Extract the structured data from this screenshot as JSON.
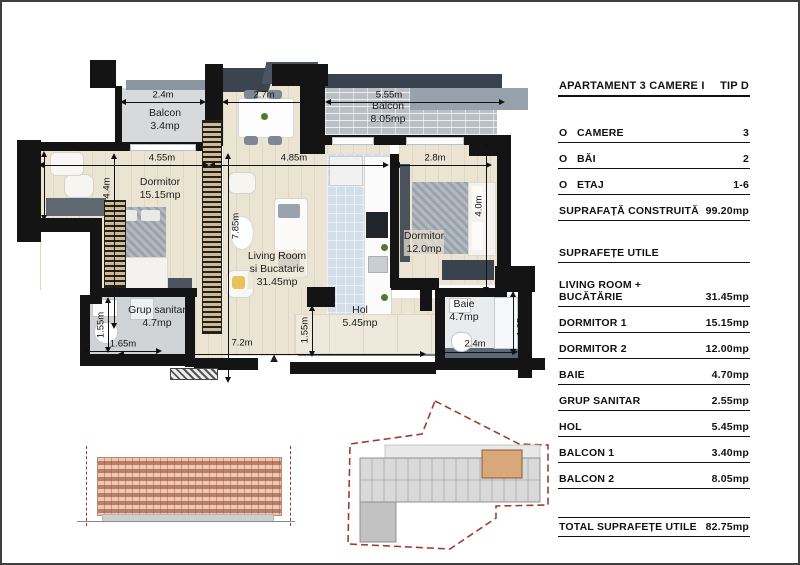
{
  "panel": {
    "title_left": "APARTAMENT 3 CAMERE  I",
    "title_right": "TIP D",
    "specs": [
      {
        "bullet": "O",
        "label": "CAMERE",
        "value": "3"
      },
      {
        "bullet": "O",
        "label": "BĂI",
        "value": "2"
      },
      {
        "bullet": "O",
        "label": "ETAJ",
        "value": "1-6"
      },
      {
        "bullet": "",
        "label": "SUPRAFAȚĂ CONSTRUITĂ",
        "value": "99.20mp"
      }
    ],
    "section_header": "SUPRAFEȚE  UTILE",
    "areas": [
      {
        "label": "LIVING ROOM + BUCĂTĂRIE",
        "value": "31.45mp"
      },
      {
        "label": "DORMITOR 1",
        "value": "15.15mp"
      },
      {
        "label": "DORMITOR 2",
        "value": "12.00mp"
      },
      {
        "label": "BAIE",
        "value": "4.70mp"
      },
      {
        "label": "GRUP SANITAR",
        "value": "2.55mp"
      },
      {
        "label": "HOL",
        "value": "5.45mp"
      },
      {
        "label": "BALCON 1",
        "value": "3.40mp"
      },
      {
        "label": "BALCON 2",
        "value": "8.05mp"
      }
    ],
    "total": {
      "label": "TOTAL SUPRAFEȚE  UTILE",
      "value": "82.75mp"
    }
  },
  "plan": {
    "rooms": [
      {
        "name": "Balcon",
        "area": "3.4mp"
      },
      {
        "name": "Balcon",
        "area": "8.05mp"
      },
      {
        "name": "Dormitor",
        "area": "15.15mp"
      },
      {
        "name": "Living Room",
        "name2": "si Bucatarie",
        "area": "31.45mp"
      },
      {
        "name": "Dormitor",
        "area": "12.0mp"
      },
      {
        "name": "Grup sanitar",
        "area": "4.7mp"
      },
      {
        "name": "Hol",
        "area": "5.45mp"
      },
      {
        "name": "Baie",
        "area": "4.7mp"
      }
    ],
    "dimensions": [
      "2.4m",
      "2.7m",
      "5.55m",
      "4.55m",
      "4.85m",
      "2.8m",
      "2.1m",
      "4.4m",
      "7.85m",
      "4.0m",
      "1.55m",
      "1.65m",
      "7.2m",
      "1.55m",
      "2.4m",
      "1.95m"
    ],
    "north_arrow": "▲"
  }
}
